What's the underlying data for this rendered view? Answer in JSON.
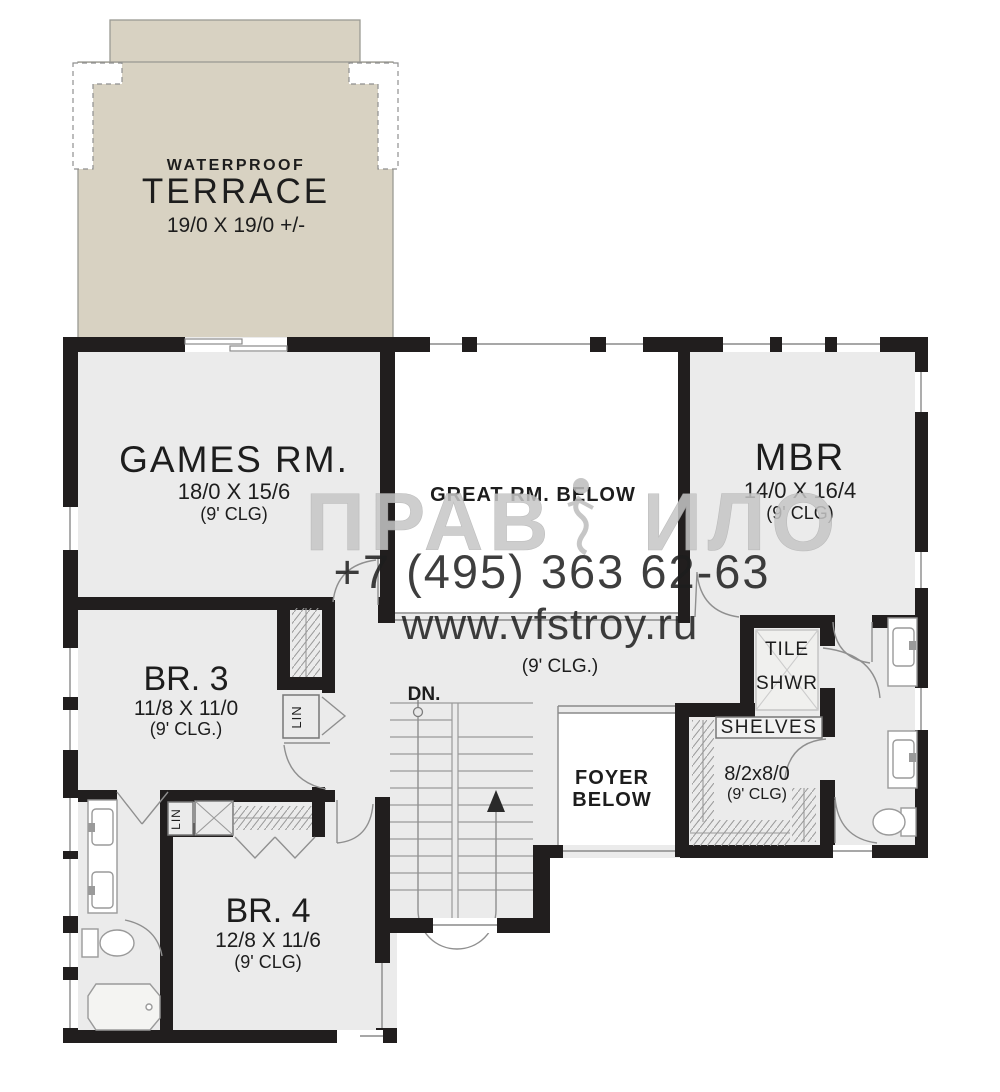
{
  "title": "Upper floor plan",
  "colors": {
    "wall": "#211e1e",
    "room_fill": "#ebebeb",
    "terrace_fill": "#d8d2c2",
    "open_below_fill": "#ffffff",
    "thin_line": "#8a8a8a",
    "watermark": "#c6c6c6"
  },
  "watermark": {
    "brand_left": "ПРАВ",
    "brand_right": "ИЛО",
    "phone": "+7 (495) 363 62-63",
    "site": "www.vfstroy.ru"
  },
  "rooms": {
    "terrace": {
      "label1": "WATERPROOF",
      "label2": "TERRACE",
      "dims": "19/0 X 19/0 +/-"
    },
    "games": {
      "name": "GAMES RM.",
      "dims": "18/0 X 15/6",
      "clg": "(9' CLG)"
    },
    "great": {
      "name": "GREAT RM. BELOW"
    },
    "mbr": {
      "name": "MBR",
      "dims": "14/0 X 16/4",
      "clg": "(9' CLG)"
    },
    "br3": {
      "name": "BR. 3",
      "dims": "11/8 X 11/0",
      "clg": "(9' CLG.)"
    },
    "br4": {
      "name": "BR. 4",
      "dims": "12/8 X 11/6",
      "clg": "(9' CLG)"
    },
    "hall": {
      "clg": "(9' CLG.)"
    },
    "stairs": {
      "label": "DN."
    },
    "foyer": {
      "line1": "FOYER",
      "line2": "BELOW"
    },
    "shower": {
      "line1": "TILE",
      "line2": "SHWR"
    },
    "wic": {
      "shelves": "SHELVES",
      "dims": "8/2x8/0",
      "clg": "(9' CLG)"
    },
    "lin1": {
      "label": "LIN"
    },
    "lin2": {
      "label": "LIN"
    }
  }
}
